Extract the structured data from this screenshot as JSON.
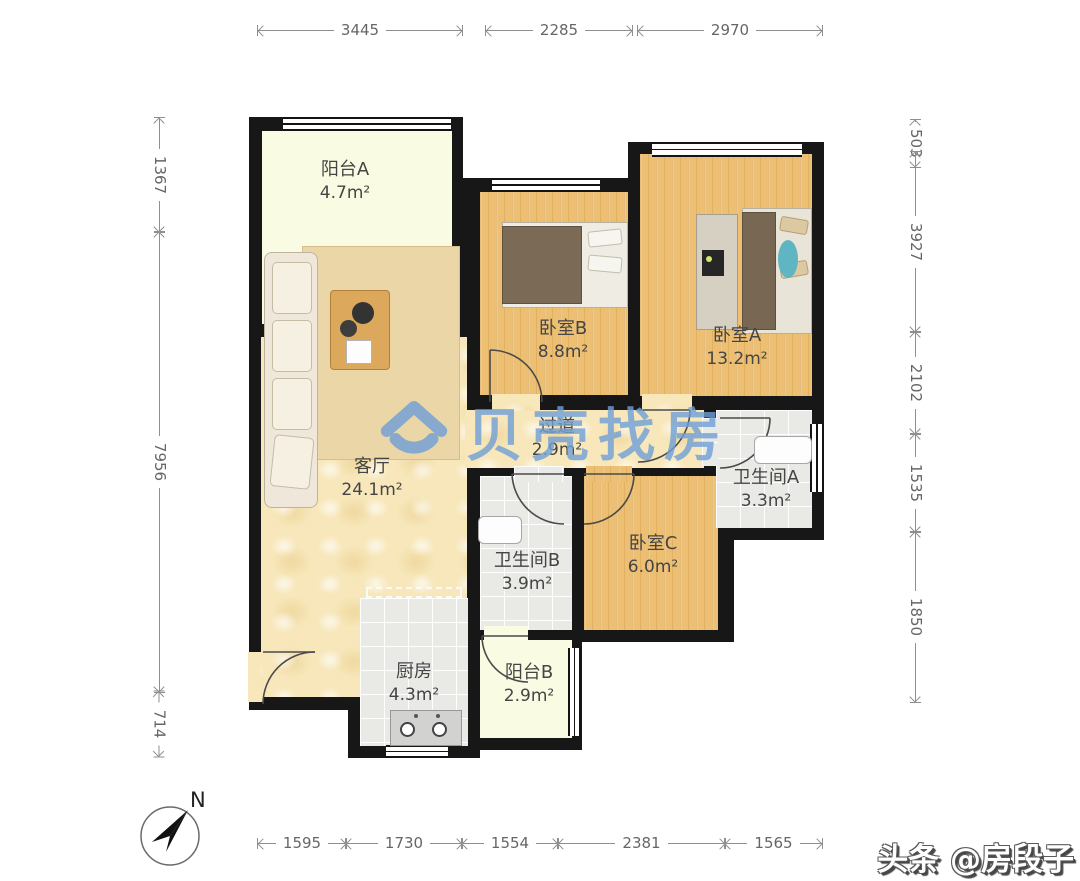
{
  "rooms": [
    {
      "name": "阳台A",
      "area": "4.7m²"
    },
    {
      "name": "客厅",
      "area": "24.1m²"
    },
    {
      "name": "卧室B",
      "area": "8.8m²"
    },
    {
      "name": "卧室A",
      "area": "13.2m²"
    },
    {
      "name": "过道",
      "area": "2.9m²"
    },
    {
      "name": "卫生间B",
      "area": "3.9m²"
    },
    {
      "name": "卧室C",
      "area": "6.0m²"
    },
    {
      "name": "卫生间A",
      "area": "3.3m²"
    },
    {
      "name": "厨房",
      "area": "4.3m²"
    },
    {
      "name": "阳台B",
      "area": "2.9m²"
    }
  ],
  "dims": {
    "top": [
      "3445",
      "2285",
      "2970"
    ],
    "bottom": [
      "1595",
      "1730",
      "1554",
      "2381",
      "1565"
    ],
    "left": [
      "1367",
      "7956",
      "714"
    ],
    "right": [
      "503",
      "3927",
      "2102",
      "1535",
      "1850"
    ]
  },
  "compass": {
    "label": "N"
  },
  "watermark": {
    "brand": "贝壳找房"
  },
  "credit": {
    "text": "头条 @房段子"
  },
  "colors": {
    "wall": "#171717",
    "wood_floor": "#edbf72",
    "living_floor": "#f7e7ba",
    "balcony_floor": "#fafbe3",
    "tile_floor": "#e9e9e6",
    "watermark_blue": "#6f9fd8",
    "dimension_gray": "#8f8f8f"
  }
}
